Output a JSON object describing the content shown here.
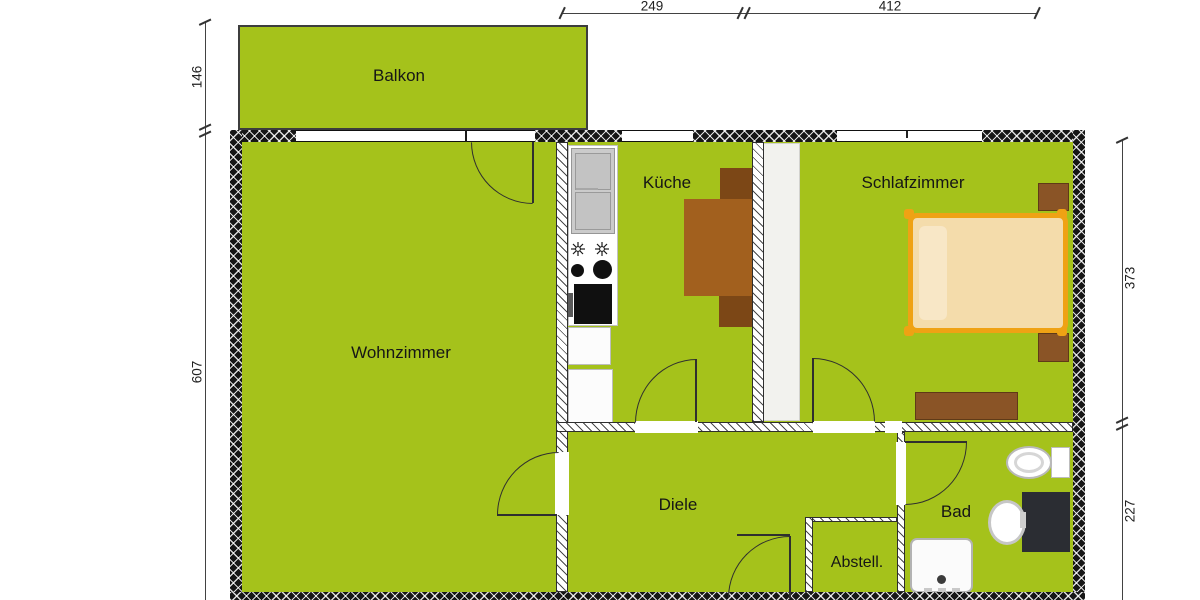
{
  "rooms": {
    "balkon": {
      "label": "Balkon"
    },
    "wohnzimmer": {
      "label": "Wohnzimmer"
    },
    "kueche": {
      "label": "Küche"
    },
    "schlafzimmer": {
      "label": "Schlafzimmer"
    },
    "diele": {
      "label": "Diele"
    },
    "abstell": {
      "label": "Abstell."
    },
    "bad": {
      "label": "Bad"
    }
  },
  "dims": {
    "top": [
      "249",
      "412"
    ],
    "left": [
      "146",
      "607"
    ],
    "right": [
      "373",
      "227"
    ]
  },
  "colors": {
    "floor": "#a5c21b",
    "outer_wall": "#161616",
    "door": "#2f2f2f",
    "wood_table": "#a2601e",
    "wood_chair": "#7c4716",
    "furniture_brown": "#8a5426",
    "bed_frame": "#efa214",
    "bed_mattress": "#f4dcab",
    "bed_pillow": "#f8e7c6",
    "counter_gray": "#cbcbcb",
    "appliance_black": "#101010",
    "fixture_white": "#fbfbfb",
    "vanity_dark": "#2b2d33"
  }
}
